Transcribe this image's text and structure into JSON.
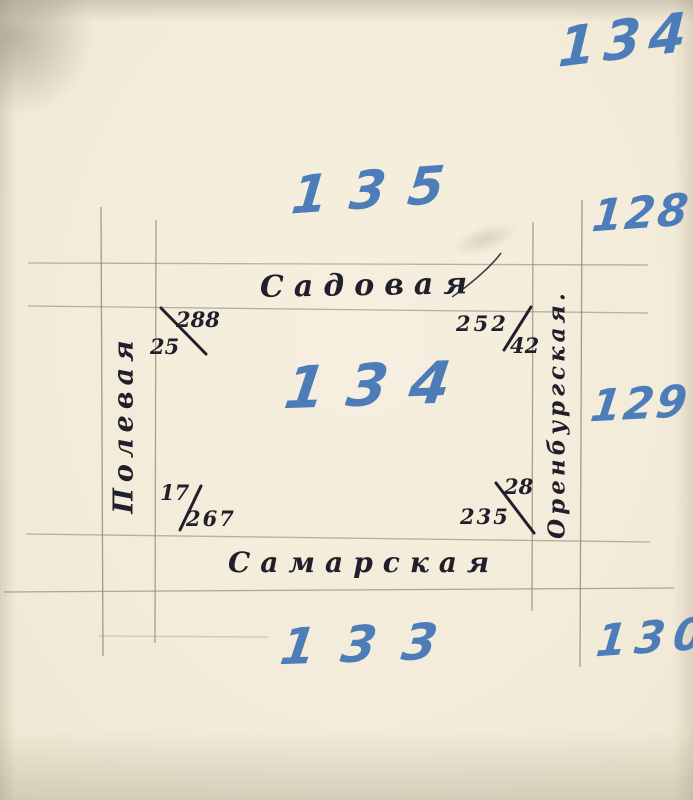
{
  "document_type": "hand-drawn city block plan",
  "palette": {
    "paper": "#f3ecda",
    "ink": "#211f2b",
    "blue_marker": "#4c7db8",
    "pencil_line": "#8f8774"
  },
  "block_numbers": {
    "outer_top_right": "134",
    "north": "135",
    "east_upper": "128",
    "center": "134",
    "east_middle": "129",
    "south": "133",
    "east_lower": "130"
  },
  "street_names": {
    "north": "Садовая",
    "south": "Самарская",
    "west": "Полевая",
    "east": "Оренбургская."
  },
  "corner_marks": {
    "top_left": {
      "upper": "288",
      "lower": "25"
    },
    "top_right": {
      "upper": "252",
      "lower": "42"
    },
    "bottom_left": {
      "upper": "17",
      "lower": "267"
    },
    "bottom_right": {
      "upper": "28",
      "lower": "235"
    }
  }
}
